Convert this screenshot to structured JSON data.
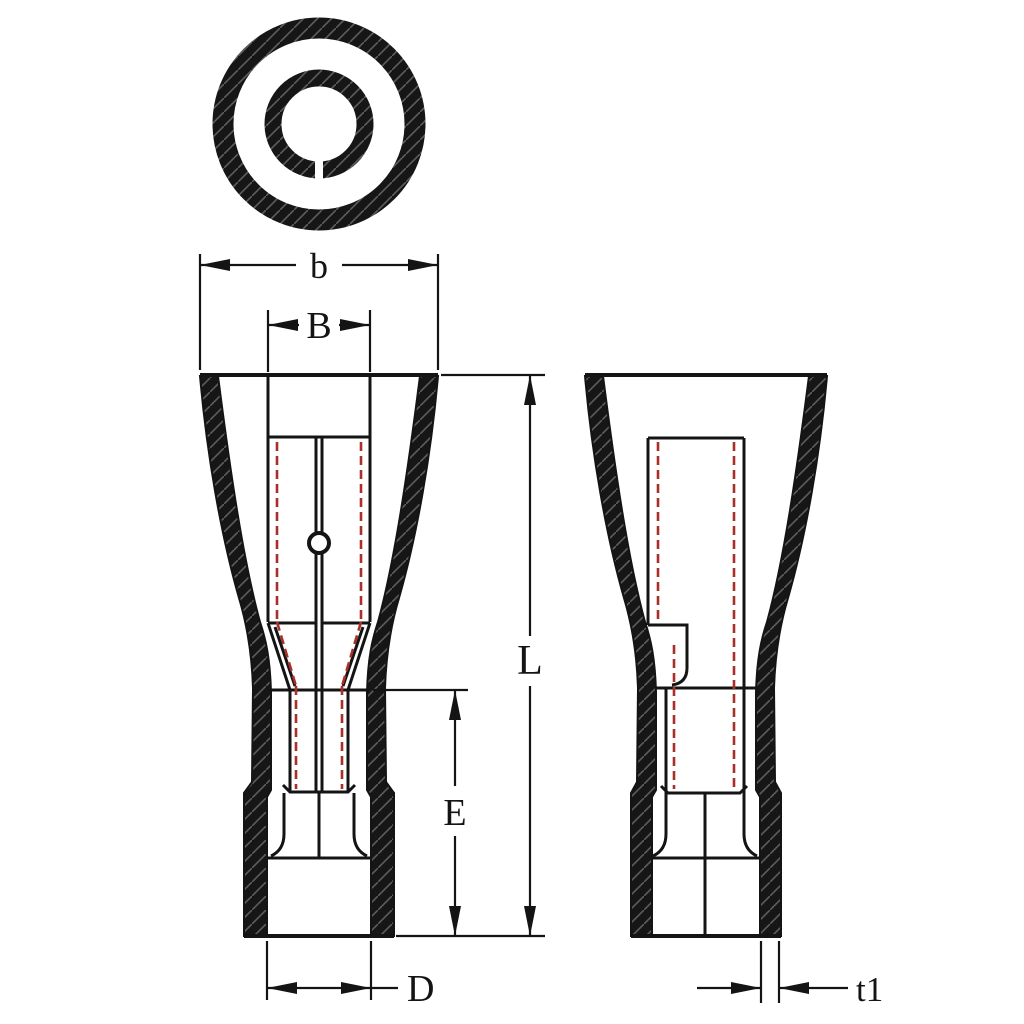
{
  "drawing": {
    "dimension_labels": {
      "b": "b",
      "B": "B",
      "L": "L",
      "E": "E",
      "D": "D",
      "t1": "t1"
    },
    "colors": {
      "outline": "#141414",
      "hidden_line": "#a93028",
      "hatch": "#5d5d5d",
      "background": "#ffffff"
    }
  }
}
